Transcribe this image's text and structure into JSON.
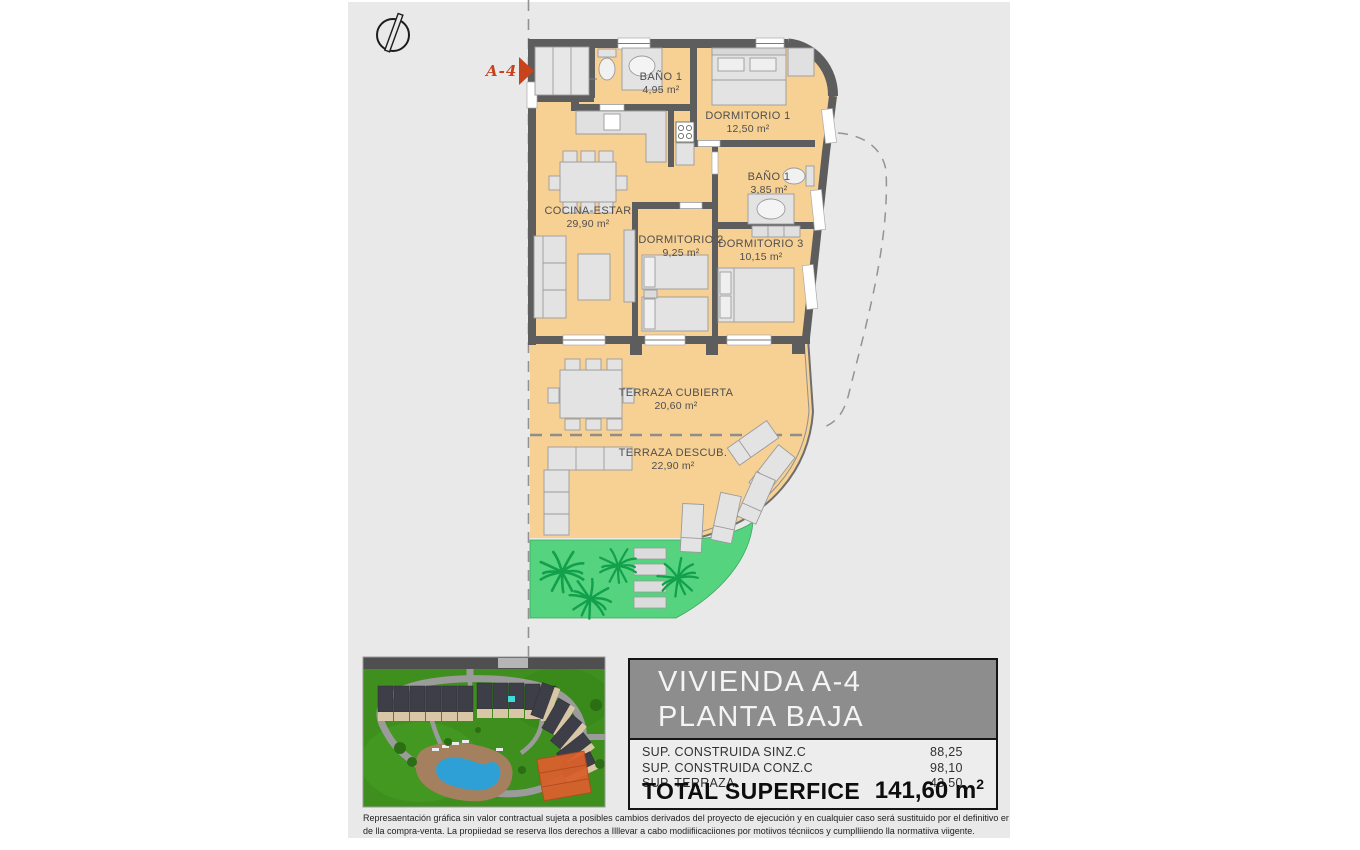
{
  "plan": {
    "unit_marker": "A-4",
    "rooms": [
      {
        "id": "banio-1",
        "name": "BAÑO 1",
        "area": "4,95 m²"
      },
      {
        "id": "dormitorio-1",
        "name": "DORMITORIO 1",
        "area": "12,50 m²"
      },
      {
        "id": "banio-2",
        "name": "BAÑO 1",
        "area": "3,85 m²"
      },
      {
        "id": "cocina-estar",
        "name": "COCINA-ESTAR",
        "area": "29,90 m²"
      },
      {
        "id": "dormitorio-2",
        "name": "DORMITORIO 2",
        "area": "9,25 m²"
      },
      {
        "id": "dormitorio-3",
        "name": "DORMITORIO 3",
        "area": "10,15 m²"
      },
      {
        "id": "terraza-cubierta",
        "name": "TERRAZA CUBIERTA",
        "area": "20,60 m²"
      },
      {
        "id": "terraza-descubierta",
        "name": "TERRAZA DESCUB.",
        "area": "22,90 m²"
      }
    ]
  },
  "info_panel": {
    "title_line1": "VIVIENDA A-4",
    "title_line2": "PLANTA BAJA",
    "rows": [
      {
        "label": "SUP. CONSTRUIDA SINZ.C",
        "value": "88,25"
      },
      {
        "label": "SUP. CONSTRUIDA CONZ.C",
        "value": "98,10"
      },
      {
        "label": "SUP. TERRAZA",
        "value": "43,50"
      }
    ],
    "total_label": "TOTAL SUPERFICE",
    "total_value": "141,60 m",
    "total_value_sup": "2"
  },
  "disclaimer": {
    "line1": "Represaentación gráfica sin valor contractual sujeta a posibles cambios derivados del proyecto de ejecución y en cualquier caso será sustituido por el definitivo er",
    "line2": "de lla compra-venta. La propiiedad se reserva llos derechos a Illlevar a cabo modiifiicaciiones por motiivos técniicos y cumplliiendo lla normatiiva viigente."
  },
  "colors": {
    "panel_bg": "#e9e9e9",
    "plan_fill": "#f7d094",
    "wall": "#5d5d5d",
    "garden_green": "#55d37e",
    "palm_green": "#12a04d",
    "marker_red": "#c8421c",
    "header_gray": "#8d8d8d",
    "pool_blue": "#2fa0d6",
    "highlight_orange": "#d9602c"
  }
}
